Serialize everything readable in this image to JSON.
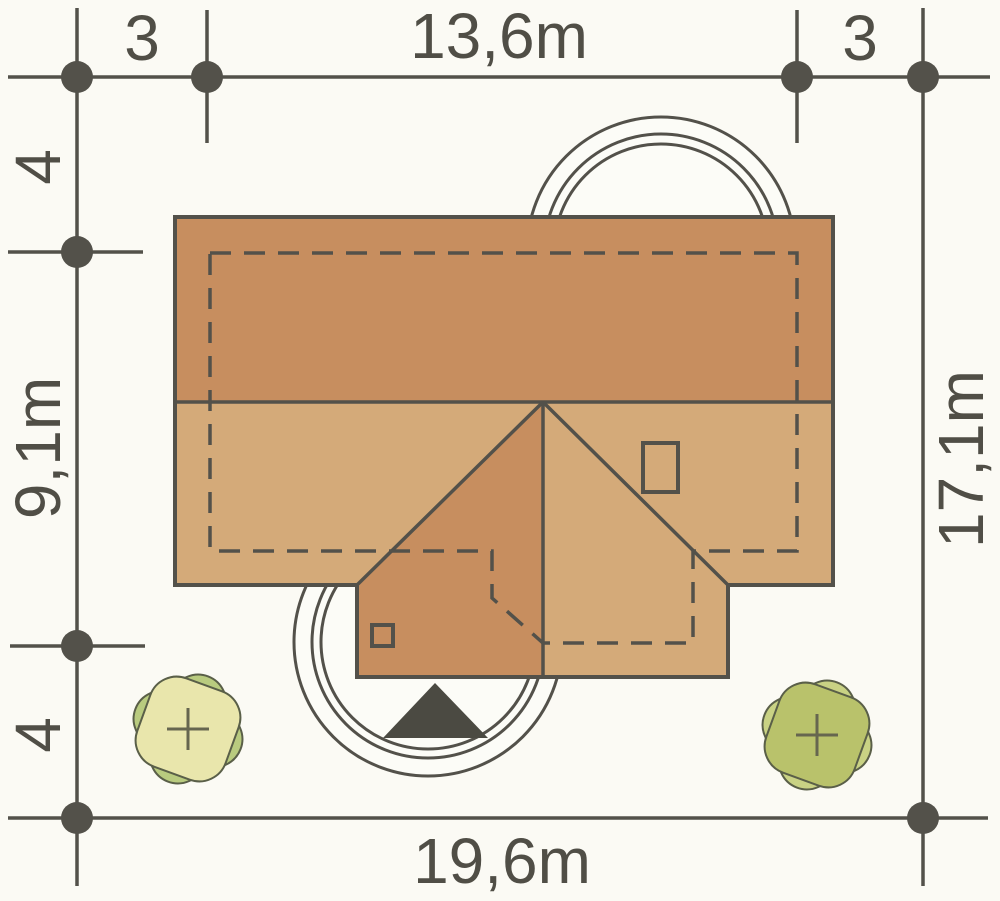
{
  "plan": {
    "type": "house site plan (roof top view)",
    "dimensions": {
      "top_left_offset": "3",
      "top_width": "13,6m",
      "top_right_offset": "3",
      "left_top_offset": "4",
      "left_height": "9,1m",
      "left_bottom_offset": "4",
      "right_height": "17,1m",
      "bottom_width": "19,6m"
    },
    "colors": {
      "plot_light": "#c9cc81",
      "plot_mid": "#b7b96c",
      "plot_dark": "#a28f46",
      "roof_dark": "#c78e5f",
      "roof_light": "#d4aa79",
      "outline": "#53514a",
      "driveway_white": "#fcfcf7",
      "tree_left_back": "#b9cb7f",
      "tree_left_front": "#e9e6ac",
      "tree_right_back": "#c9d284",
      "tree_right_front": "#b9c26b",
      "entrance_marker": "#4b4a42"
    }
  }
}
